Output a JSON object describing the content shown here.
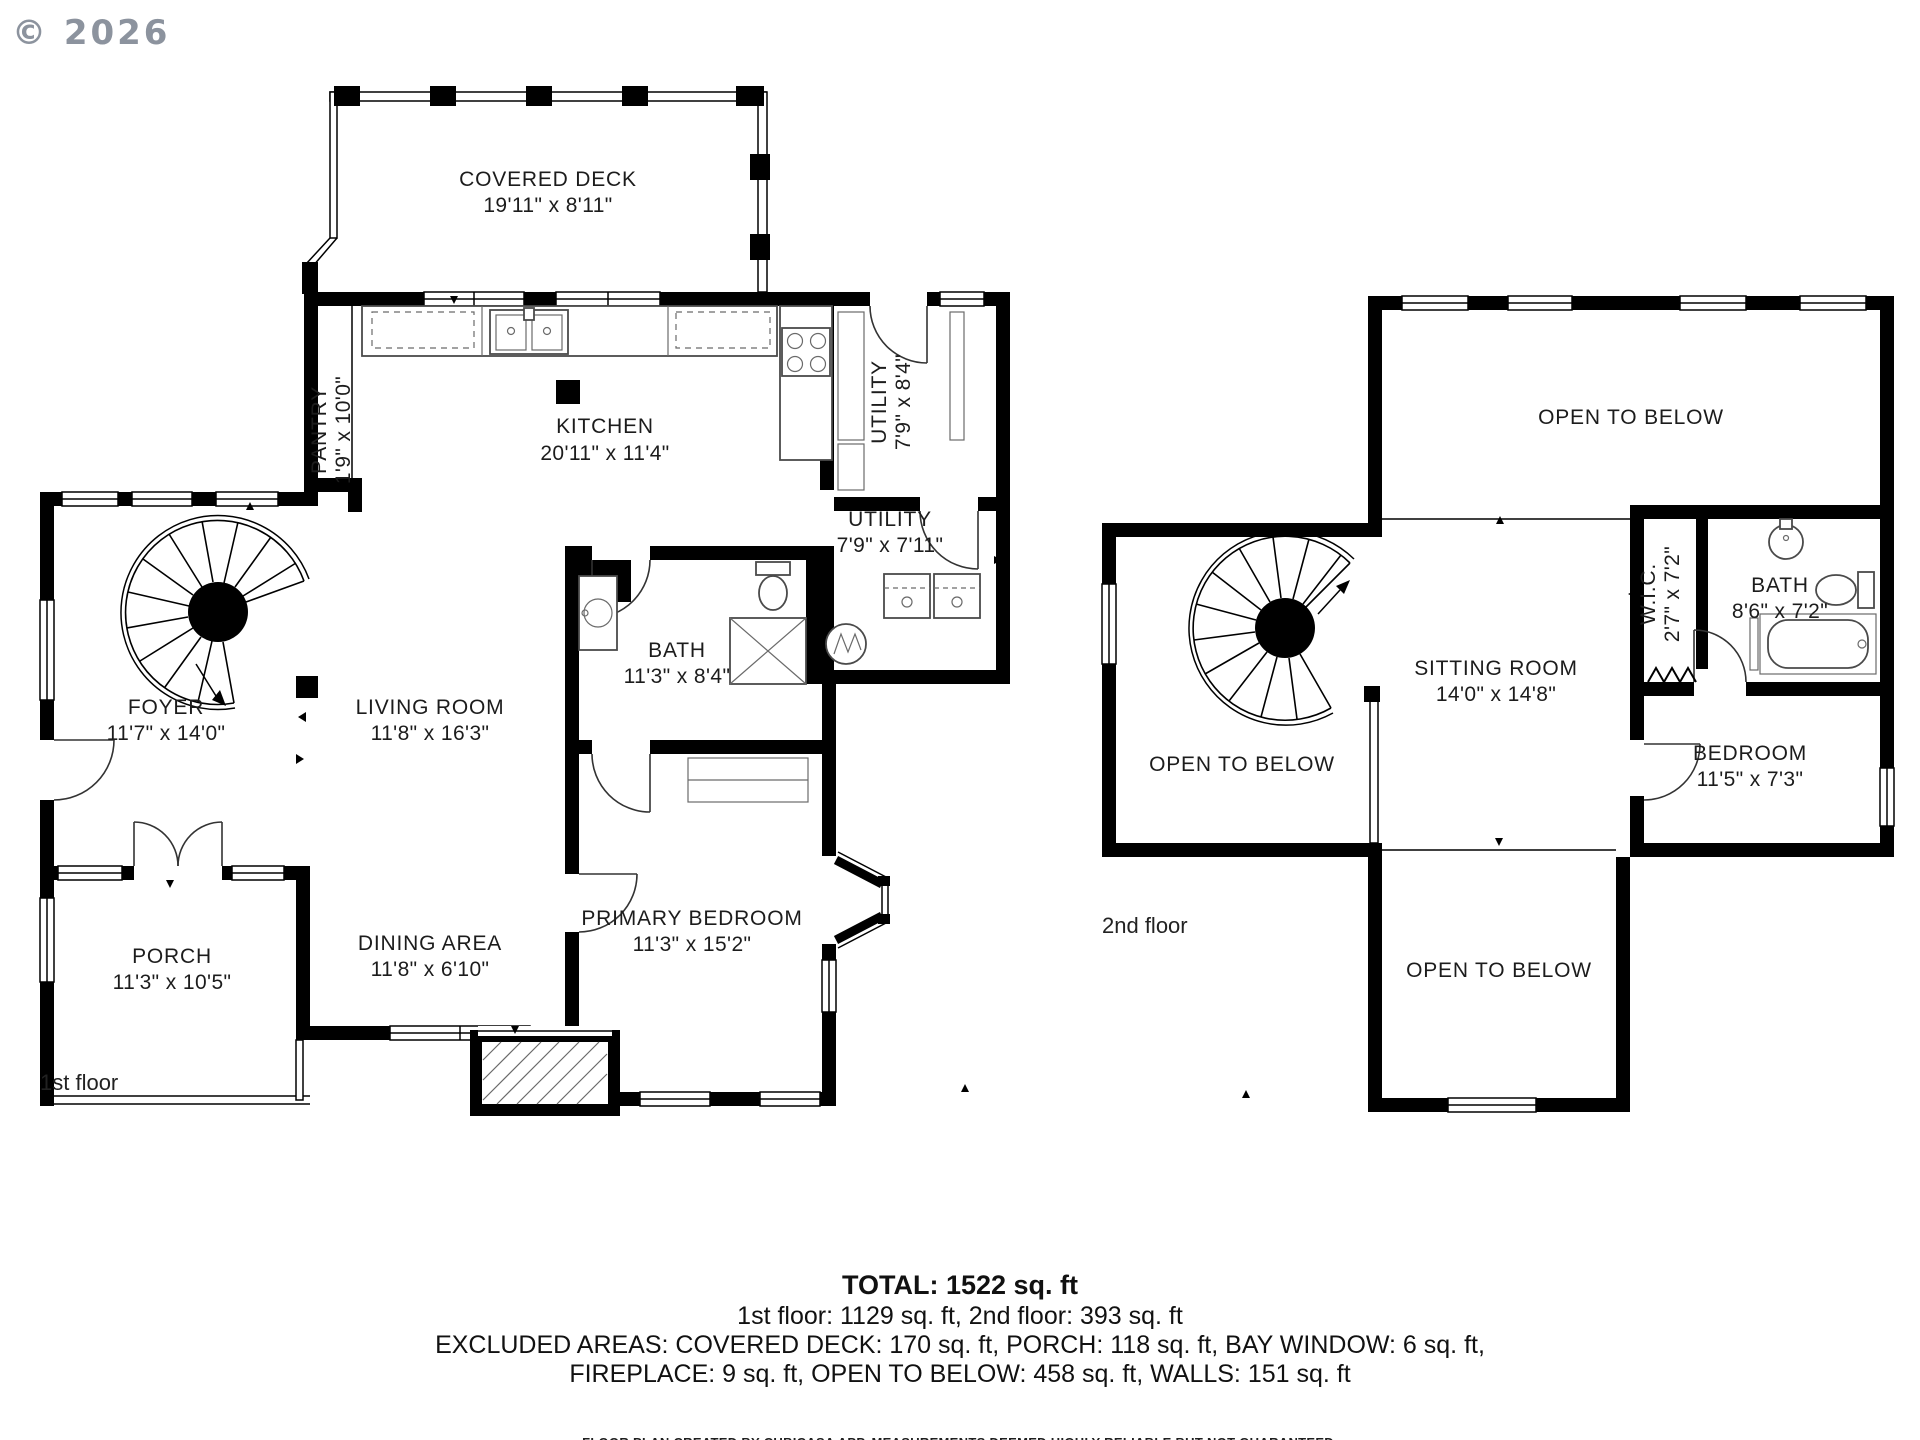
{
  "copyright": "© 2026",
  "floor1": {
    "name": "1st floor",
    "rooms": {
      "covered_deck": {
        "label": "COVERED DECK",
        "dims": "19'11\" x 8'11\""
      },
      "pantry": {
        "label": "PANTRY",
        "dims": "1'9\" x 10'0\""
      },
      "kitchen": {
        "label": "KITCHEN",
        "dims": "20'11\" x 11'4\""
      },
      "utility_upper": {
        "label": "UTILITY",
        "dims": "7'9\" x 8'4\""
      },
      "utility_lower": {
        "label": "UTILITY",
        "dims": "7'9\" x 7'11\""
      },
      "bath": {
        "label": "BATH",
        "dims": "11'3\" x 8'4\""
      },
      "foyer": {
        "label": "FOYER",
        "dims": "11'7\" x 14'0\""
      },
      "living_room": {
        "label": "LIVING ROOM",
        "dims": "11'8\" x 16'3\""
      },
      "porch": {
        "label": "PORCH",
        "dims": "11'3\" x 10'5\""
      },
      "dining_area": {
        "label": "DINING AREA",
        "dims": "11'8\" x 6'10\""
      },
      "primary_bedroom": {
        "label": "PRIMARY BEDROOM",
        "dims": "11'3\" x 15'2\""
      }
    }
  },
  "floor2": {
    "name": "2nd floor",
    "rooms": {
      "open_below_top": {
        "label": "OPEN TO BELOW"
      },
      "open_below_left": {
        "label": "OPEN TO BELOW"
      },
      "open_below_bottom": {
        "label": "OPEN TO BELOW"
      },
      "sitting_room": {
        "label": "SITTING ROOM",
        "dims": "14'0\" x 14'8\""
      },
      "wic": {
        "label": "W.I.C.",
        "dims": "2'7\" x 7'2\""
      },
      "bath": {
        "label": "BATH",
        "dims": "8'6\" x 7'2\""
      },
      "bedroom": {
        "label": "BEDROOM",
        "dims": "11'5\" x 7'3\""
      }
    }
  },
  "summary": {
    "total": "TOTAL: 1522 sq. ft",
    "floors": "1st floor: 1129 sq. ft, 2nd floor: 393 sq. ft",
    "excluded_line1": "EXCLUDED AREAS: COVERED DECK: 170 sq. ft, PORCH: 118 sq. ft, BAY WINDOW: 6 sq. ft,",
    "excluded_line2": "FIREPLACE: 9 sq. ft, OPEN TO BELOW: 458 sq. ft, WALLS: 151 sq. ft",
    "disclaimer": "FLOOR PLAN CREATED BY CUBICASA APP. MEASUREMENTS DEEMED HIGHLY RELIABLE BUT NOT GUARANTEED."
  },
  "colors": {
    "wall": "#000000",
    "background": "#ffffff",
    "text": "#1c1c1c",
    "copyright": "#8c939e"
  }
}
